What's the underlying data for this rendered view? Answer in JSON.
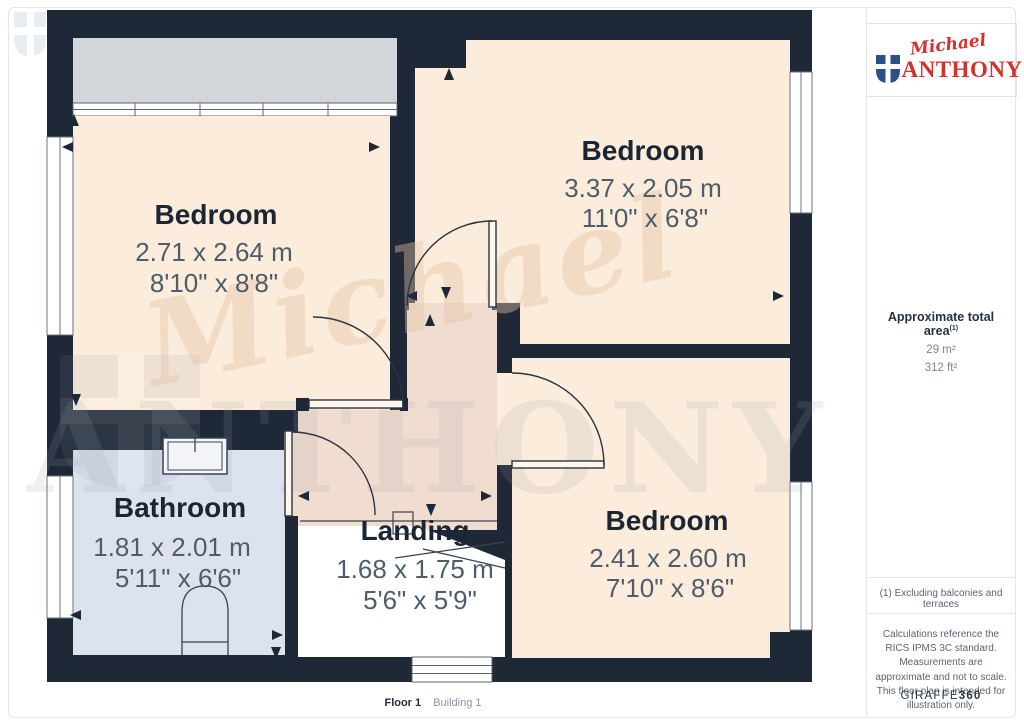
{
  "branding": {
    "script": "Michael",
    "caps": "ANTHONY",
    "logo_color": "#d6302c",
    "shield_color": "#2d4f87"
  },
  "sidebar": {
    "area": {
      "title": "Approximate total area",
      "superscript": "(1)",
      "metric": "29 m²",
      "imperial": "312 ft²"
    },
    "note": "(1) Excluding balconies and terraces",
    "disclaimer": "Calculations reference the RICS IPMS 3C standard. Measurements are approximate and not to scale. This floor plan is intended for illustration only.",
    "brand_footer": {
      "name": "GIRAFFE",
      "suffix": "360"
    }
  },
  "footer": {
    "floor_label": "Floor 1",
    "building_label": "Building 1"
  },
  "floorplan": {
    "wall_color": "#1e2836",
    "room_fill": "#fcecdb",
    "landing_fill": "#f1ddcf",
    "bathroom_fill": "#dce3ee",
    "bay_fill": "#d2d5d9",
    "watermark": {
      "script": "Michael",
      "caps": "ANTHONY"
    },
    "rooms": [
      {
        "name": "Bedroom",
        "metric": "2.71 x 2.64 m",
        "imperial": "8'10\" x 8'8\""
      },
      {
        "name": "Bedroom",
        "metric": "3.37 x 2.05 m",
        "imperial": "11'0\" x 6'8\""
      },
      {
        "name": "Bedroom",
        "metric": "2.41 x 2.60 m",
        "imperial": "7'10\" x 8'6\""
      },
      {
        "name": "Bathroom",
        "metric": "1.81 x 2.01 m",
        "imperial": "5'11\" x 6'6\""
      },
      {
        "name": "Landing",
        "metric": "1.68 x 1.75 m",
        "imperial": "5'6\" x 5'9\""
      }
    ]
  }
}
